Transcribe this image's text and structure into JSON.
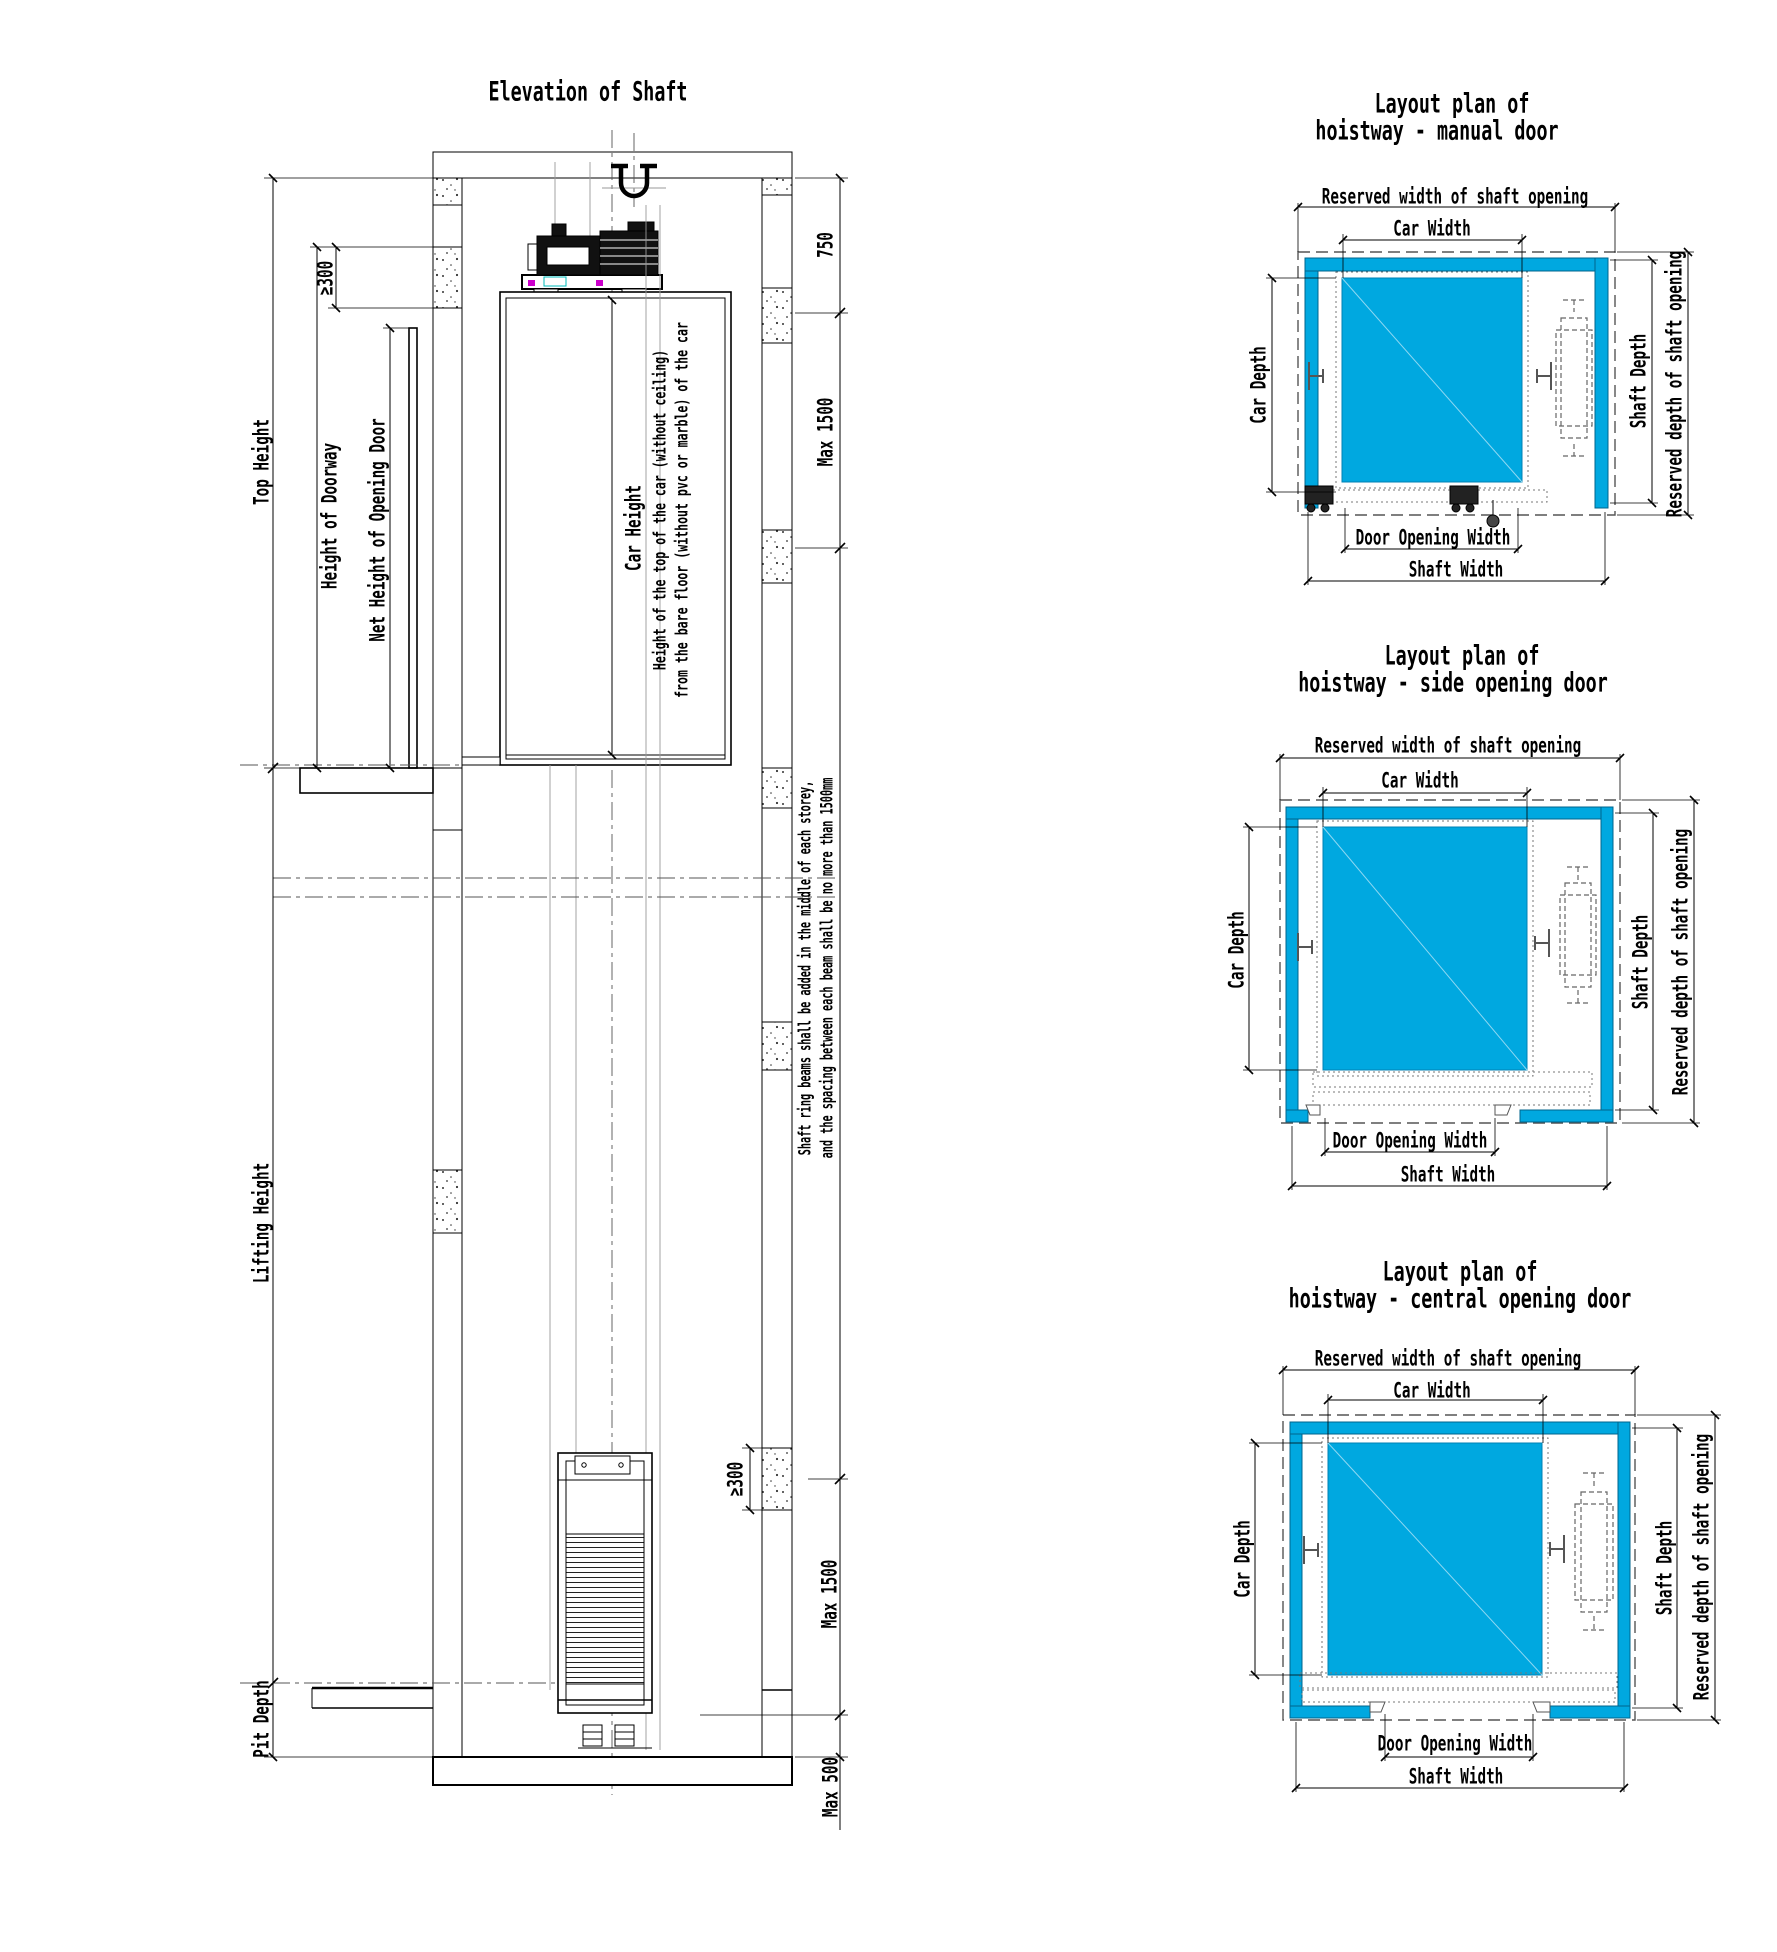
{
  "colors": {
    "wall_fill": "#00A8E0",
    "car_fill": "#00A8E0",
    "machine_accent_magenta": "#CC00CC",
    "machine_accent_cyan": "#00BBBB"
  },
  "elevation": {
    "title": "Elevation of Shaft",
    "dims": {
      "top_height": "Top Height",
      "height_of_doorway": "Height of Doorway",
      "net_height_of_opening_door": "Net Height of Opening Door",
      "min_300_top": "≥300",
      "car_height": "Car Height",
      "car_height_note_1": "Height of the top of the car (without ceiling)",
      "car_height_note_2": "from the bare floor (without pvc or marble) of the car",
      "headroom_750": "750",
      "max_1500_top": "Max 1500",
      "ring_beam_note_1": "Shaft ring beams shall be added in the middle of each storey,",
      "ring_beam_note_2": "and the spacing between each beam shall be no more than 1500mm",
      "lifting_height": "Lifting Height",
      "min_300_bottom": "≥300",
      "max_1500_bottom": "Max 1500",
      "pit_depth": "Pit Depth",
      "max_500_bottom": "Max 500"
    }
  },
  "plans": [
    {
      "title_line_1": "Layout plan of",
      "title_line_2": "hoistway - manual door",
      "dims": {
        "reserved_width": "Reserved width of shaft opening",
        "car_width": "Car Width",
        "car_depth": "Car Depth",
        "shaft_depth": "Shaft Depth",
        "reserved_depth": "Reserved depth of shaft opening",
        "door_opening_width": "Door Opening Width",
        "shaft_width": "Shaft Width"
      }
    },
    {
      "title_line_1": "Layout plan of",
      "title_line_2": "hoistway - side opening door",
      "dims": {
        "reserved_width": "Reserved width of shaft opening",
        "car_width": "Car Width",
        "car_depth": "Car Depth",
        "shaft_depth": "Shaft Depth",
        "reserved_depth": "Reserved depth of shaft opening",
        "door_opening_width": "Door Opening Width",
        "shaft_width": "Shaft Width"
      }
    },
    {
      "title_line_1": "Layout plan of",
      "title_line_2": "hoistway - central opening door",
      "dims": {
        "reserved_width": "Reserved width of shaft opening",
        "car_width": "Car Width",
        "car_depth": "Car Depth",
        "shaft_depth": "Shaft Depth",
        "reserved_depth": "Reserved depth of shaft opening",
        "door_opening_width": "Door Opening Width",
        "shaft_width": "Shaft Width"
      }
    }
  ]
}
